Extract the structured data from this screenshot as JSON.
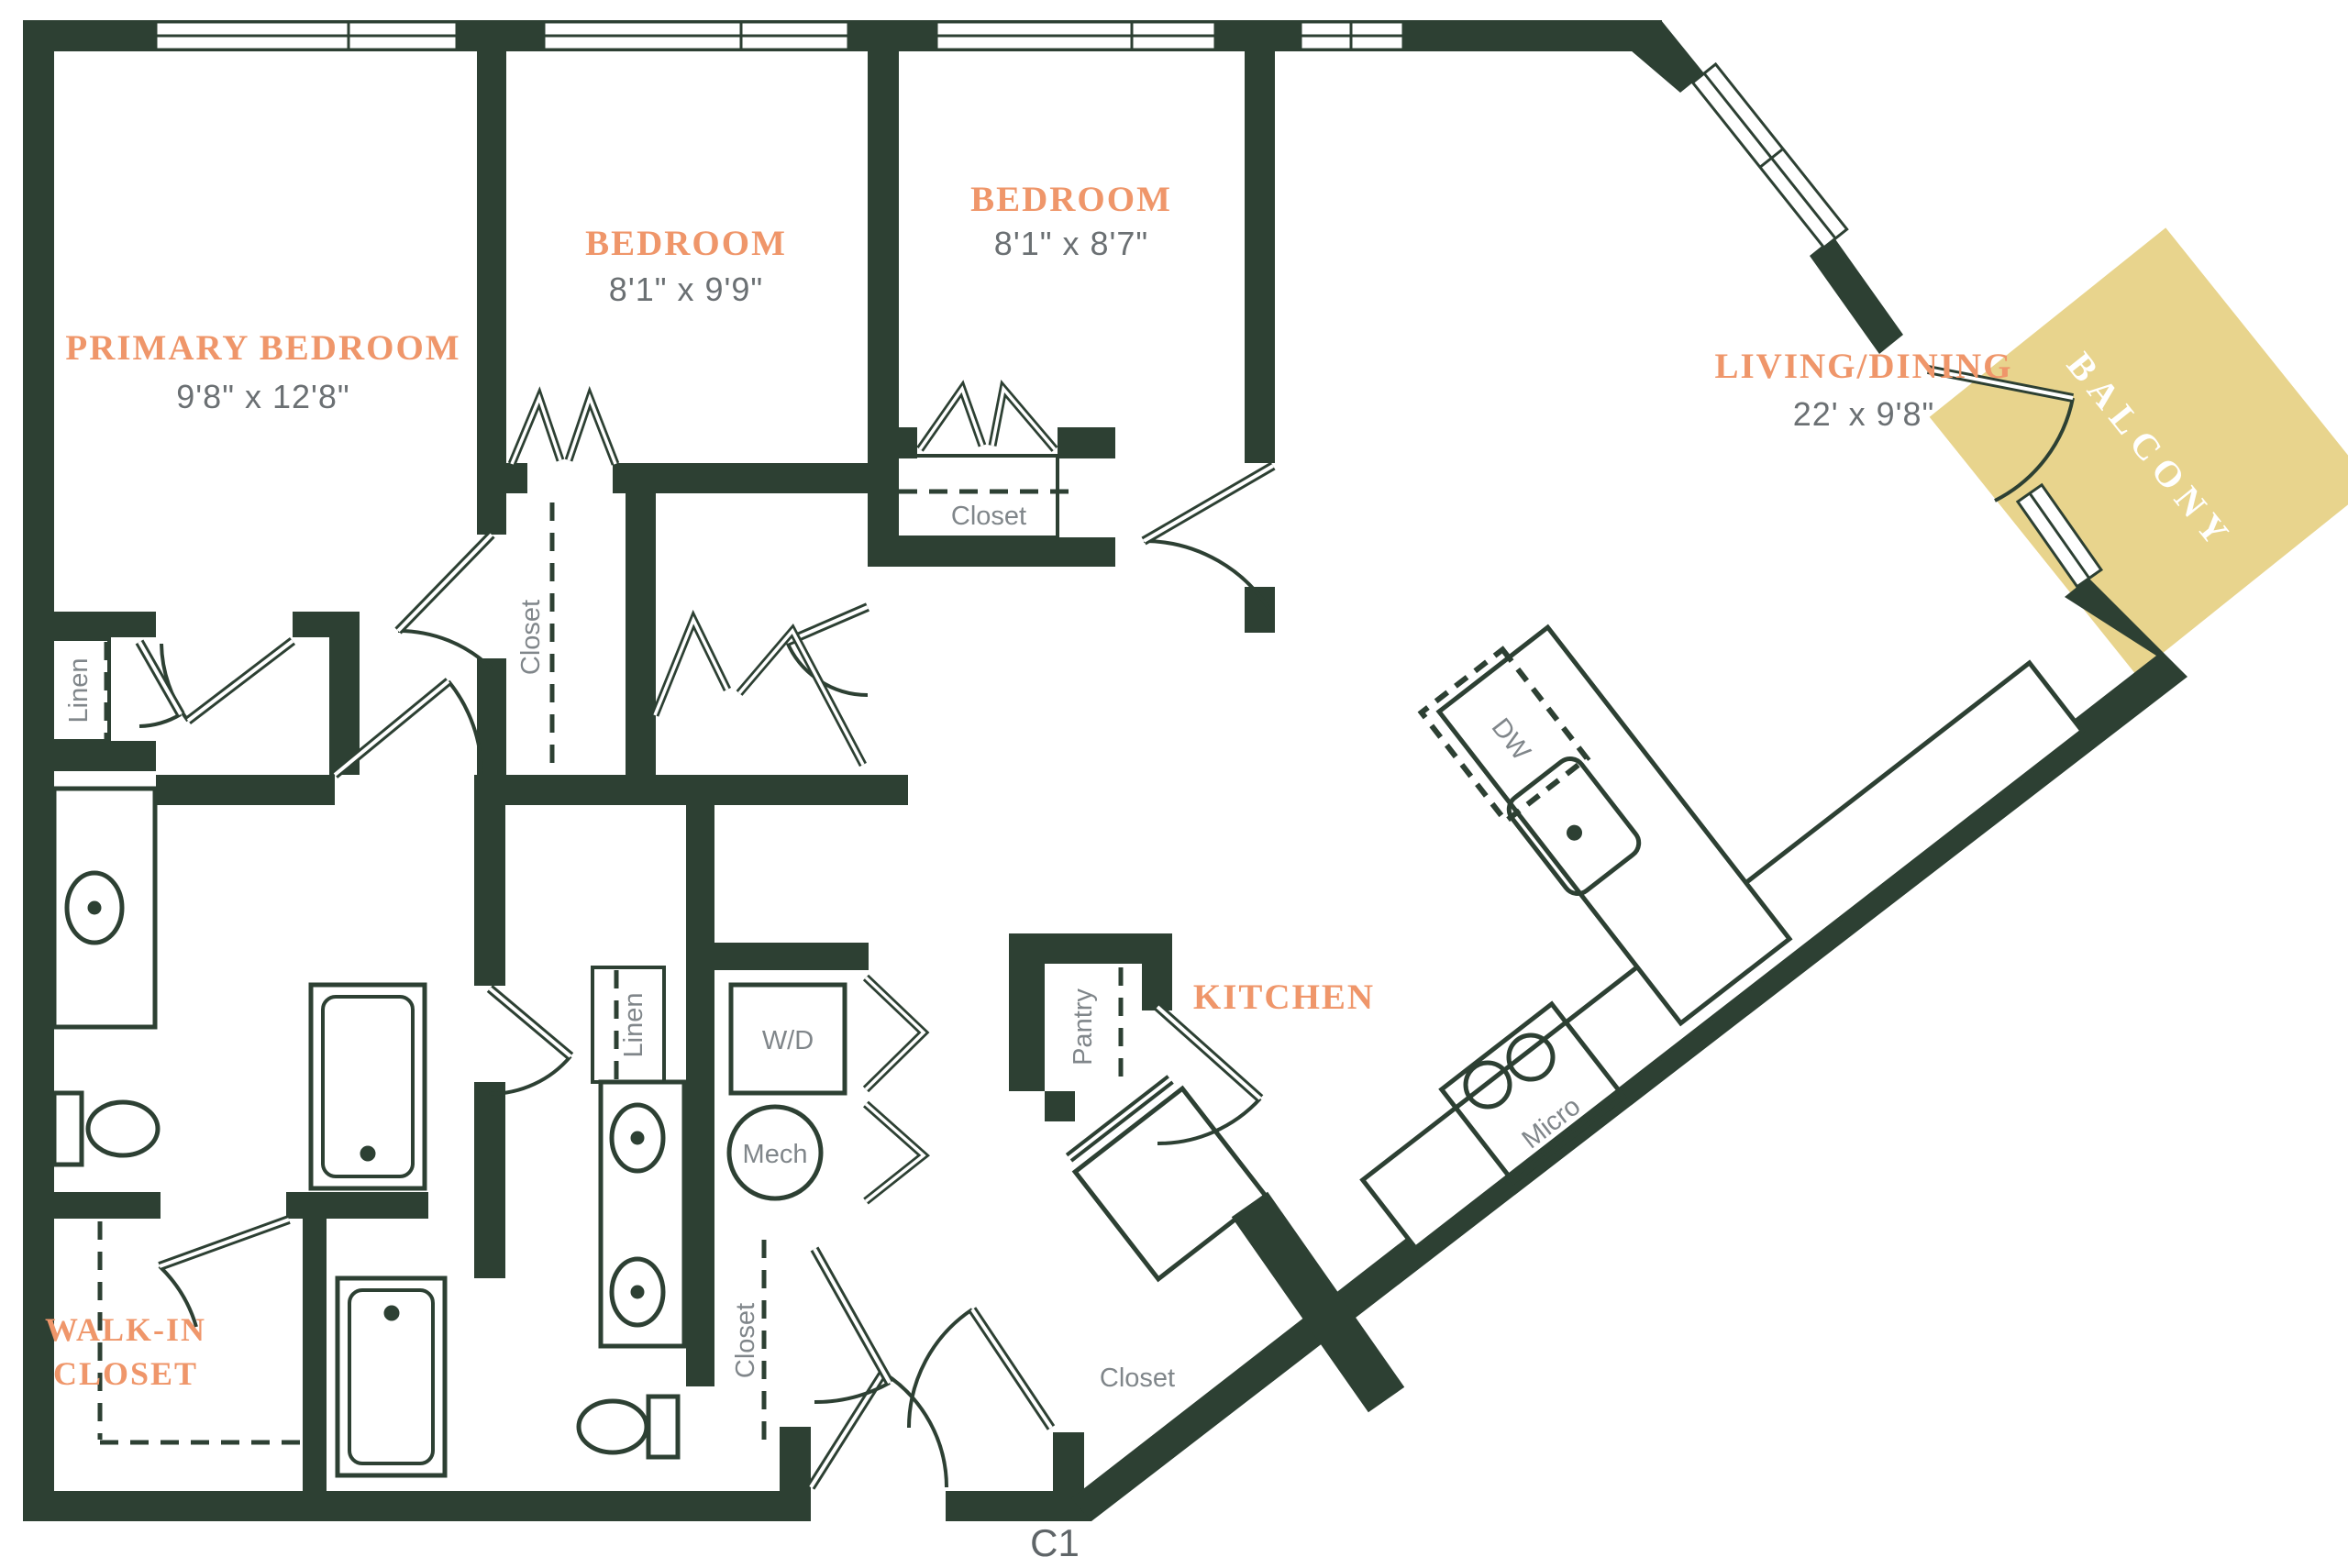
{
  "plan_code": "C1",
  "colors": {
    "wall": "#2d4033",
    "accent_text": "#ef966a",
    "dim_text": "#6b7073",
    "balcony_fill": "#e8d48d"
  },
  "rooms": {
    "primary": {
      "name": "PRIMARY BEDROOM",
      "dims": "9'8\" x 12'8\""
    },
    "bedroom2": {
      "name": "BEDROOM",
      "dims": "8'1\" x 9'9\""
    },
    "bedroom3": {
      "name": "BEDROOM",
      "dims": "8'1\" x 8'7\""
    },
    "living": {
      "name": "LIVING/DINING",
      "dims": "22' x 9'8\""
    },
    "kitchen": {
      "name": "KITCHEN"
    },
    "walk_in_closet": {
      "line1": "WALK-IN",
      "line2": "CLOSET"
    },
    "balcony": {
      "name": "BALCONY"
    }
  },
  "fixtures": {
    "linen_primary": "Linen",
    "linen_bath2": "Linen",
    "closet_bedroom2": "Closet",
    "closet_bedroom3": "Closet",
    "closet_hall": "Closet",
    "closet_entry": "Closet",
    "pantry": "Pantry",
    "washer_dryer": "W/D",
    "mechanical": "Mech",
    "dishwasher": "DW",
    "microwave": "Micro"
  }
}
